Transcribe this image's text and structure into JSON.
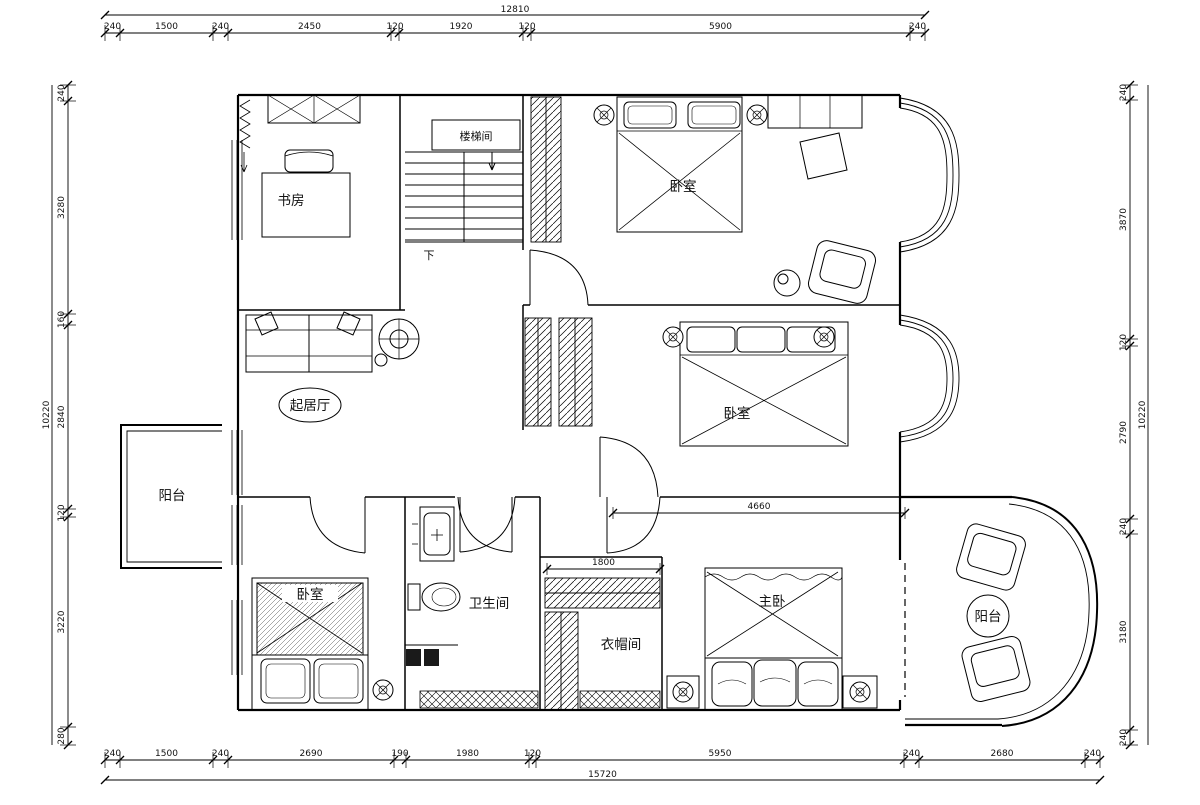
{
  "drawing": {
    "kind": "residential upper-floor plan",
    "background": "#ffffff",
    "line_color": "#000000"
  },
  "rooms": {
    "study": "书房",
    "stairwell": "楼梯间",
    "bedroom_top": "卧室",
    "bedroom_mid": "卧室",
    "bedroom_left": "卧室",
    "living": "起居厅",
    "balcony_left": "阳台",
    "bathroom": "卫生间",
    "cloakroom": "衣帽间",
    "master": "主卧",
    "balcony_right": "阳台",
    "down_label": "下"
  },
  "dims": {
    "top": {
      "total": "12810",
      "segments": [
        "240",
        "1500",
        "240",
        "2450",
        "120",
        "1920",
        "120",
        "5900",
        "240"
      ]
    },
    "bottom": {
      "total": "15720",
      "segments": [
        "240",
        "1500",
        "240",
        "2690",
        "190",
        "1980",
        "120",
        "5950",
        "240",
        "2680",
        "240"
      ]
    },
    "left": {
      "total": "10220",
      "segments": [
        "240",
        "3280",
        "160",
        "2840",
        "120",
        "3220",
        "280"
      ]
    },
    "right": {
      "total": "10220",
      "segments": [
        "240",
        "3870",
        "120",
        "2790",
        "240",
        "3180",
        "240"
      ]
    },
    "interior": {
      "bedroom_mid_width": "4660",
      "cloakroom_width": "1800"
    }
  }
}
